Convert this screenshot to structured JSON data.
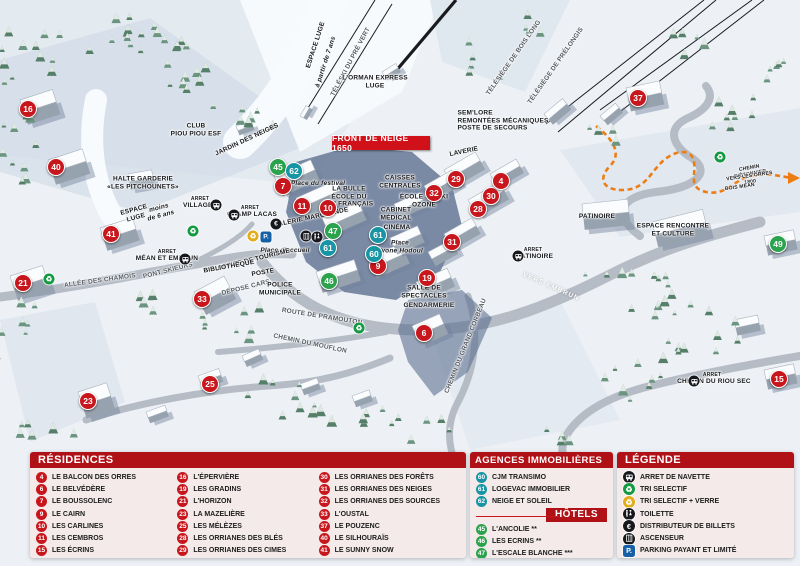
{
  "banner": "FRONT DE NEIGE 1650",
  "map": {
    "marker_colors": {
      "r": "#c8161d",
      "h": "#2ba24c",
      "a": "#1795a5"
    },
    "accent_colors": {
      "header_red": "#b01117",
      "banner_red": "#d01119",
      "path_orange": "#ed7d12",
      "parking_blue": "#1660a8",
      "recycle_green": "#159a43",
      "recycle_yellow": "#e2ac1b"
    },
    "markers": [
      {
        "n": "16",
        "t": "r",
        "x": 28,
        "y": 109
      },
      {
        "n": "40",
        "t": "r",
        "x": 56,
        "y": 167
      },
      {
        "n": "41",
        "t": "r",
        "x": 111,
        "y": 234
      },
      {
        "n": "21",
        "t": "r",
        "x": 23,
        "y": 283
      },
      {
        "n": "33",
        "t": "r",
        "x": 202,
        "y": 299
      },
      {
        "n": "23",
        "t": "r",
        "x": 88,
        "y": 401
      },
      {
        "n": "25",
        "t": "r",
        "x": 210,
        "y": 384
      },
      {
        "n": "7",
        "t": "r",
        "x": 283,
        "y": 186
      },
      {
        "n": "11",
        "t": "r",
        "x": 302,
        "y": 206
      },
      {
        "n": "10",
        "t": "r",
        "x": 328,
        "y": 208
      },
      {
        "n": "9",
        "t": "r",
        "x": 378,
        "y": 266
      },
      {
        "n": "19",
        "t": "r",
        "x": 427,
        "y": 278
      },
      {
        "n": "6",
        "t": "r",
        "x": 424,
        "y": 333
      },
      {
        "n": "29",
        "t": "r",
        "x": 456,
        "y": 179
      },
      {
        "n": "32",
        "t": "r",
        "x": 434,
        "y": 193
      },
      {
        "n": "30",
        "t": "r",
        "x": 491,
        "y": 196
      },
      {
        "n": "28",
        "t": "r",
        "x": 478,
        "y": 209
      },
      {
        "n": "4",
        "t": "r",
        "x": 501,
        "y": 181
      },
      {
        "n": "31",
        "t": "r",
        "x": 452,
        "y": 242
      },
      {
        "n": "37",
        "t": "r",
        "x": 638,
        "y": 98
      },
      {
        "n": "15",
        "t": "r",
        "x": 779,
        "y": 379
      },
      {
        "n": "45",
        "t": "h",
        "x": 278,
        "y": 167
      },
      {
        "n": "47",
        "t": "h",
        "x": 333,
        "y": 231
      },
      {
        "n": "46",
        "t": "h",
        "x": 329,
        "y": 281
      },
      {
        "n": "49",
        "t": "h",
        "x": 778,
        "y": 244
      },
      {
        "n": "62",
        "t": "a",
        "x": 294,
        "y": 171
      },
      {
        "n": "61",
        "t": "a",
        "x": 378,
        "y": 235
      },
      {
        "n": "61",
        "t": "a",
        "x": 328,
        "y": 248
      },
      {
        "n": "60",
        "t": "a",
        "x": 374,
        "y": 254
      }
    ],
    "labels": [
      {
        "t": "ESPACE LUGE",
        "x": 316,
        "y": 45,
        "r": -72
      },
      {
        "t": "à partir de 7 ans",
        "x": 326,
        "y": 62,
        "r": -72,
        "i": 1
      },
      {
        "t": "TÉLÉSKI DU PRÉ VERT",
        "x": 351,
        "y": 62,
        "r": -62,
        "road": 1
      },
      {
        "t": "L'ORMAN EXPRESS\nLUGE",
        "x": 375,
        "y": 82
      },
      {
        "t": "TÉLÉSIÈGE DE BOIS LONG",
        "x": 514,
        "y": 58,
        "r": -55,
        "road": 1
      },
      {
        "t": "TÉLÉSIÈGE DE PRÉLONGIS",
        "x": 556,
        "y": 66,
        "r": -55,
        "road": 1
      },
      {
        "t": "SEM'LORE\nREMONTÉES MÉCANIQUES\nPOSTE DE SECOURS",
        "x": 503,
        "y": 121,
        "left": 1
      },
      {
        "t": "JARDIN DES NEIGES",
        "x": 247,
        "y": 140,
        "r": -25
      },
      {
        "t": "CLUB\nPIOU PIOU ESF",
        "x": 196,
        "y": 130
      },
      {
        "t": "HALTE GARDERIE\n«LES PITCHOUNETS»",
        "x": 143,
        "y": 183
      },
      {
        "t": "ESPACE\nLUGE",
        "x": 135,
        "y": 214,
        "r": -15
      },
      {
        "t": "moins\nde 6 ans",
        "x": 160,
        "y": 212,
        "r": -15,
        "i": 1
      },
      {
        "t": "ARRET",
        "x": 200,
        "y": 200,
        "s": 5
      },
      {
        "t": "VILLAGES",
        "x": 200,
        "y": 206
      },
      {
        "t": "ARRET",
        "x": 250,
        "y": 209,
        "s": 5
      },
      {
        "t": "CHAMP LACAS",
        "x": 252,
        "y": 215
      },
      {
        "t": "ARRET",
        "x": 167,
        "y": 253,
        "s": 5
      },
      {
        "t": "MÉAN ET EMBRUN",
        "x": 167,
        "y": 259
      },
      {
        "t": "ALLÉE DES CHAMOIS",
        "x": 100,
        "y": 281,
        "r": -8,
        "road": 1
      },
      {
        "t": "PONT SKIEURS",
        "x": 168,
        "y": 271,
        "r": -14,
        "road": 1
      },
      {
        "t": "GALERIE MARCHANDE",
        "x": 311,
        "y": 218,
        "r": -12
      },
      {
        "t": "LA BULLE\nÉCOLE DU\nSKI FRANÇAIS",
        "x": 349,
        "y": 197
      },
      {
        "t": "Place du festival",
        "x": 318,
        "y": 184,
        "i": 1
      },
      {
        "t": "Place d'accueil",
        "x": 285,
        "y": 251,
        "i": 1
      },
      {
        "t": "Place\nYvone Hodoul",
        "x": 400,
        "y": 247,
        "i": 1
      },
      {
        "t": "CAISSES\nCENTRALES",
        "x": 400,
        "y": 182
      },
      {
        "t": "CABINET\nMÉDICAL",
        "x": 396,
        "y": 214
      },
      {
        "t": "CINÉMA",
        "x": 397,
        "y": 228
      },
      {
        "t": "ÉCOLE DE SKI\nOZONE",
        "x": 424,
        "y": 201
      },
      {
        "t": "LAVERIE",
        "x": 464,
        "y": 152,
        "r": -12
      },
      {
        "t": "OFFICE DE TOURISME",
        "x": 254,
        "y": 260,
        "r": -14
      },
      {
        "t": "BIBLIOTHÈQUE",
        "x": 229,
        "y": 267,
        "r": -10
      },
      {
        "t": "POSTE",
        "x": 263,
        "y": 273,
        "r": -10
      },
      {
        "t": "DÉPOSE CARS",
        "x": 246,
        "y": 288,
        "r": -14,
        "road": 1
      },
      {
        "t": "POLICE\nMUNICIPALE",
        "x": 280,
        "y": 289
      },
      {
        "t": "SALLE DE\nSPECTACLES",
        "x": 424,
        "y": 292
      },
      {
        "t": "GENDARMERIE",
        "x": 429,
        "y": 306
      },
      {
        "t": "ROUTE DE PRAMOUTON",
        "x": 322,
        "y": 317,
        "r": 9,
        "road": 1
      },
      {
        "t": "CHEMIN DU MOUFLON",
        "x": 310,
        "y": 344,
        "r": 12,
        "road": 1
      },
      {
        "t": "CHEMIN DU GRAND CORBEAU",
        "x": 466,
        "y": 346,
        "r": -68,
        "road": 1
      },
      {
        "t": "ARRET",
        "x": 533,
        "y": 251,
        "s": 5
      },
      {
        "t": "PATINOIRE",
        "x": 535,
        "y": 257
      },
      {
        "t": "PATINOIRE",
        "x": 597,
        "y": 217
      },
      {
        "t": "ESPACE RENCONTRE\nET CULTURE",
        "x": 673,
        "y": 230
      },
      {
        "t": "VERS EMBRUN",
        "x": 551,
        "y": 287,
        "r": 24,
        "w": 1
      },
      {
        "t": "ARRET",
        "x": 712,
        "y": 376,
        "s": 5
      },
      {
        "t": "CHEMIN DU RIOU SEC",
        "x": 714,
        "y": 382
      },
      {
        "t": "CHEMIN PIÉTONNIER",
        "x": 750,
        "y": 172,
        "r": -10,
        "s": 5
      },
      {
        "t": "VERS LES ORRES 1800",
        "x": 750,
        "y": 180,
        "r": -8,
        "s": 5
      },
      {
        "t": "BOIS MÉAN",
        "x": 740,
        "y": 188,
        "r": -8,
        "s": 5
      }
    ],
    "icons": [
      {
        "type": "bus-icon",
        "x": 216,
        "y": 205
      },
      {
        "type": "bus-icon",
        "x": 234,
        "y": 215
      },
      {
        "type": "bus-icon",
        "x": 185,
        "y": 259
      },
      {
        "type": "bus-icon",
        "x": 518,
        "y": 256
      },
      {
        "type": "bus-icon",
        "x": 694,
        "y": 381
      },
      {
        "type": "recycle-green-icon",
        "x": 49,
        "y": 279
      },
      {
        "type": "recycle-green-icon",
        "x": 193,
        "y": 231
      },
      {
        "type": "recycle-green-icon",
        "x": 359,
        "y": 328
      },
      {
        "type": "recycle-green-icon",
        "x": 720,
        "y": 157
      },
      {
        "type": "recycle-yellow-icon",
        "x": 253,
        "y": 236
      },
      {
        "type": "euro-icon",
        "x": 276,
        "y": 224
      },
      {
        "type": "parking-icon",
        "x": 266,
        "y": 237
      },
      {
        "type": "elevator-icon",
        "x": 306,
        "y": 236
      },
      {
        "type": "toilet-icon",
        "x": 317,
        "y": 237
      }
    ]
  },
  "panels": {
    "residences": {
      "title": "RÉSIDENCES",
      "columns": [
        [
          {
            "num": "4",
            "name": "LE BALCON DES ORRES"
          },
          {
            "num": "6",
            "name": "LE BELVÉDÈRE"
          },
          {
            "num": "7",
            "name": "LE BOUSSOLENC"
          },
          {
            "num": "9",
            "name": "LE CAIRN"
          },
          {
            "num": "10",
            "name": "LES CARLINES"
          },
          {
            "num": "11",
            "name": "LES CEMBROS"
          },
          {
            "num": "15",
            "name": "LES ÉCRINS"
          }
        ],
        [
          {
            "num": "16",
            "name": "L'ÉPERVIÈRE"
          },
          {
            "num": "19",
            "name": "LES GRADINS"
          },
          {
            "num": "21",
            "name": "L'HORIZON"
          },
          {
            "num": "23",
            "name": "LA MAZELIÈRE"
          },
          {
            "num": "25",
            "name": "LES MÉLÈZES"
          },
          {
            "num": "28",
            "name": "LES ORRIANES DES BLÉS"
          },
          {
            "num": "29",
            "name": "LES ORRIANES DES CIMES"
          }
        ],
        [
          {
            "num": "30",
            "name": "LES ORRIANES DES FORÊTS"
          },
          {
            "num": "31",
            "name": "LES ORRIANES DES NEIGES"
          },
          {
            "num": "32",
            "name": "LES ORRIANES DES SOURCES"
          },
          {
            "num": "33",
            "name": "L'OUSTAL"
          },
          {
            "num": "37",
            "name": "LE POUZENC"
          },
          {
            "num": "40",
            "name": "LE SILHOURAÏS"
          },
          {
            "num": "41",
            "name": "LE SUNNY SNOW"
          }
        ]
      ]
    },
    "agences": {
      "title": "AGENCES IMMOBILIÈRES",
      "items": [
        {
          "num": "60",
          "name": "CJM TRANSIMO"
        },
        {
          "num": "61",
          "name": "LOGEVAC IMMOBILIER"
        },
        {
          "num": "62",
          "name": "NEIGE ET SOLEIL"
        }
      ]
    },
    "hotels": {
      "title": "HÔTELS",
      "items": [
        {
          "num": "45",
          "name": "L'ANCOLIE **"
        },
        {
          "num": "46",
          "name": "LES ECRINS **"
        },
        {
          "num": "47",
          "name": "L'ESCALE BLANCHE ***"
        },
        {
          "num": "49",
          "name": "LES TRAPPEURS **"
        }
      ]
    },
    "legende": {
      "title": "LÉGENDE",
      "items": [
        {
          "icon": "bus-icon",
          "label": "ARRET DE NAVETTE"
        },
        {
          "icon": "recycle-green-icon",
          "label": "TRI SELECTIF"
        },
        {
          "icon": "recycle-yellow-icon",
          "label": "TRI SELECTIF + VERRE"
        },
        {
          "icon": "toilet-icon",
          "label": "TOILETTE"
        },
        {
          "icon": "euro-icon",
          "label": "DISTRIBUTEUR DE BILLETS"
        },
        {
          "icon": "elevator-icon",
          "label": "ASCENSEUR"
        },
        {
          "icon": "parking-icon",
          "label": "PARKING PAYANT ET LIMITÉ"
        }
      ]
    }
  }
}
